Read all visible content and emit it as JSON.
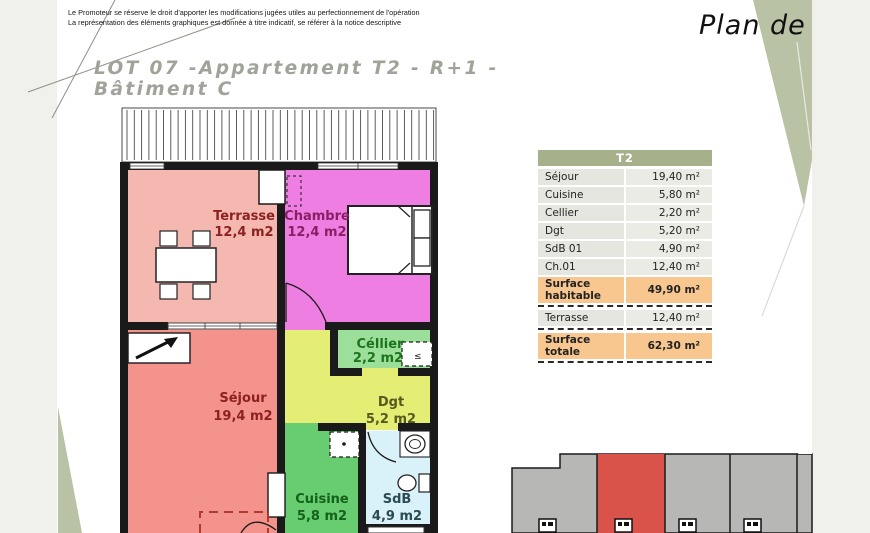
{
  "page": {
    "disclaimer": [
      "Le Promoteur se réserve le droit d'apporter les modifications jugées utiles au perfectionnement de l'opération",
      "La représentation des éléments graphiques est donnée à titre indicatif, se référer à la notice descriptive"
    ],
    "corner_label": "Plan de",
    "title": "LOT 07 -Appartement T2 - R+1 - Bâtiment C"
  },
  "table": {
    "header": "T2",
    "rows": [
      {
        "label": "Séjour",
        "value": "19,40 m²"
      },
      {
        "label": "Cuisine",
        "value": "5,80 m²"
      },
      {
        "label": "Cellier",
        "value": "2,20 m²"
      },
      {
        "label": "Dgt",
        "value": "5,20 m²"
      },
      {
        "label": "SdB 01",
        "value": "4,90 m²"
      },
      {
        "label": "Ch.01",
        "value": "12,40 m²"
      },
      {
        "label": "Surface habitable",
        "value": "49,90 m²",
        "highlight": true,
        "dashed_after": true
      },
      {
        "label": "Terrasse",
        "value": "12,40 m²",
        "dashed_after": true
      },
      {
        "label": "Surface totale",
        "value": "62,30 m²",
        "highlight": true,
        "dashed_after": true
      }
    ],
    "colors": {
      "header_bg": "#a6b18c",
      "row_bg": "#e6e6e1",
      "highlight_bg": "#f7c78f"
    }
  },
  "plan": {
    "rooms": {
      "terrasse": {
        "label": "Terrasse",
        "area": "12,4 m2",
        "color": "#f4b8b1",
        "text_color": "#8c2121"
      },
      "chambre": {
        "label": "Chambre",
        "area": "12,4 m2",
        "color": "#ee7ee2",
        "text_color": "#8a1f66"
      },
      "sejour": {
        "label": "Séjour",
        "area": "19,4 m2",
        "color": "#f3938b",
        "text_color": "#8c2121"
      },
      "cellier": {
        "label": "Céllier",
        "area": "2,2 m2",
        "color": "#9bdf9b",
        "text_color": "#1c741c"
      },
      "dgt": {
        "label": "Dgt",
        "area": "5,2 m2",
        "color": "#e5ee74",
        "text_color": "#56591f"
      },
      "cuisine": {
        "label": "Cuisine",
        "area": "5,8 m2",
        "color": "#67cd70",
        "text_color": "#14611c"
      },
      "sdb": {
        "label": "SdB",
        "area": "4,9 m2",
        "color": "#d9f1f8",
        "text_color": "#2c4a52"
      }
    },
    "wall_color": "#1a1a1a"
  },
  "mini_plan": {
    "block_color": "#b7b7b5",
    "highlight_color": "#d9534b",
    "marker_x": [
      547,
      623,
      687,
      752
    ]
  },
  "decor": {
    "wedge_color": "#b9c2a5",
    "strip_color": "#f0f0ed",
    "line_color": "#8f8f86"
  }
}
